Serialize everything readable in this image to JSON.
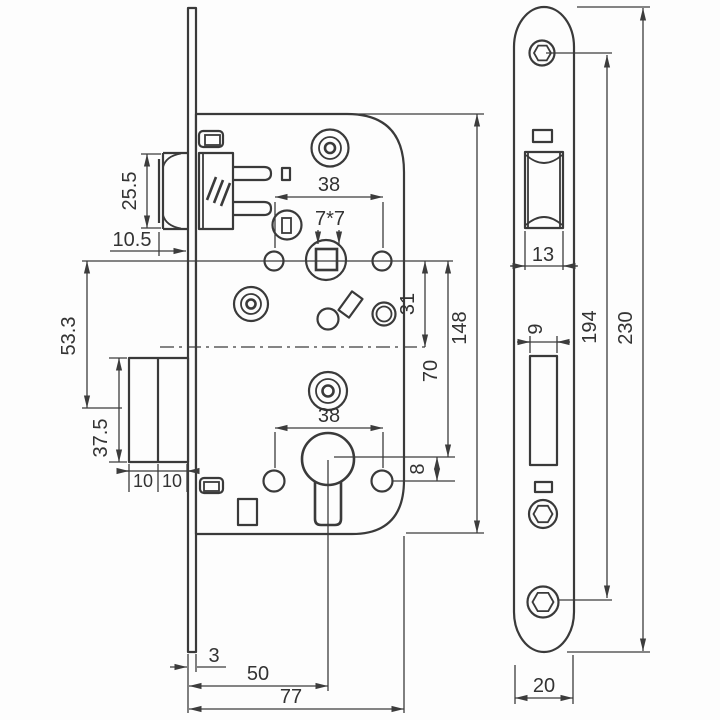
{
  "drawing": {
    "type": "technical-drawing",
    "subject": "mortise-door-lock",
    "line_color": "#3a3a3a",
    "background": "#fdfdfd",
    "labels": {
      "latch_height": "25.5",
      "latch_protrusion": "10.5",
      "axis_to_bolt_center": "53.3",
      "deadbolt_height": "37.5",
      "bolt_front_width": "10",
      "bolt_back_width": "10",
      "top_hole_spacing": "38",
      "spindle_square": "7*7",
      "axis_to_centerline": "31",
      "axis_to_cylinder": "70",
      "case_height": "148",
      "cylinder_to_hole": "8",
      "bottom_hole_spacing": "38",
      "plate_thickness": "3",
      "backset": "50",
      "case_depth": "77",
      "latch_cutout_width": "13",
      "bolt_cutout_width": "9",
      "screw_hole_spacing": "194",
      "plate_length": "230",
      "plate_width": "20"
    }
  }
}
